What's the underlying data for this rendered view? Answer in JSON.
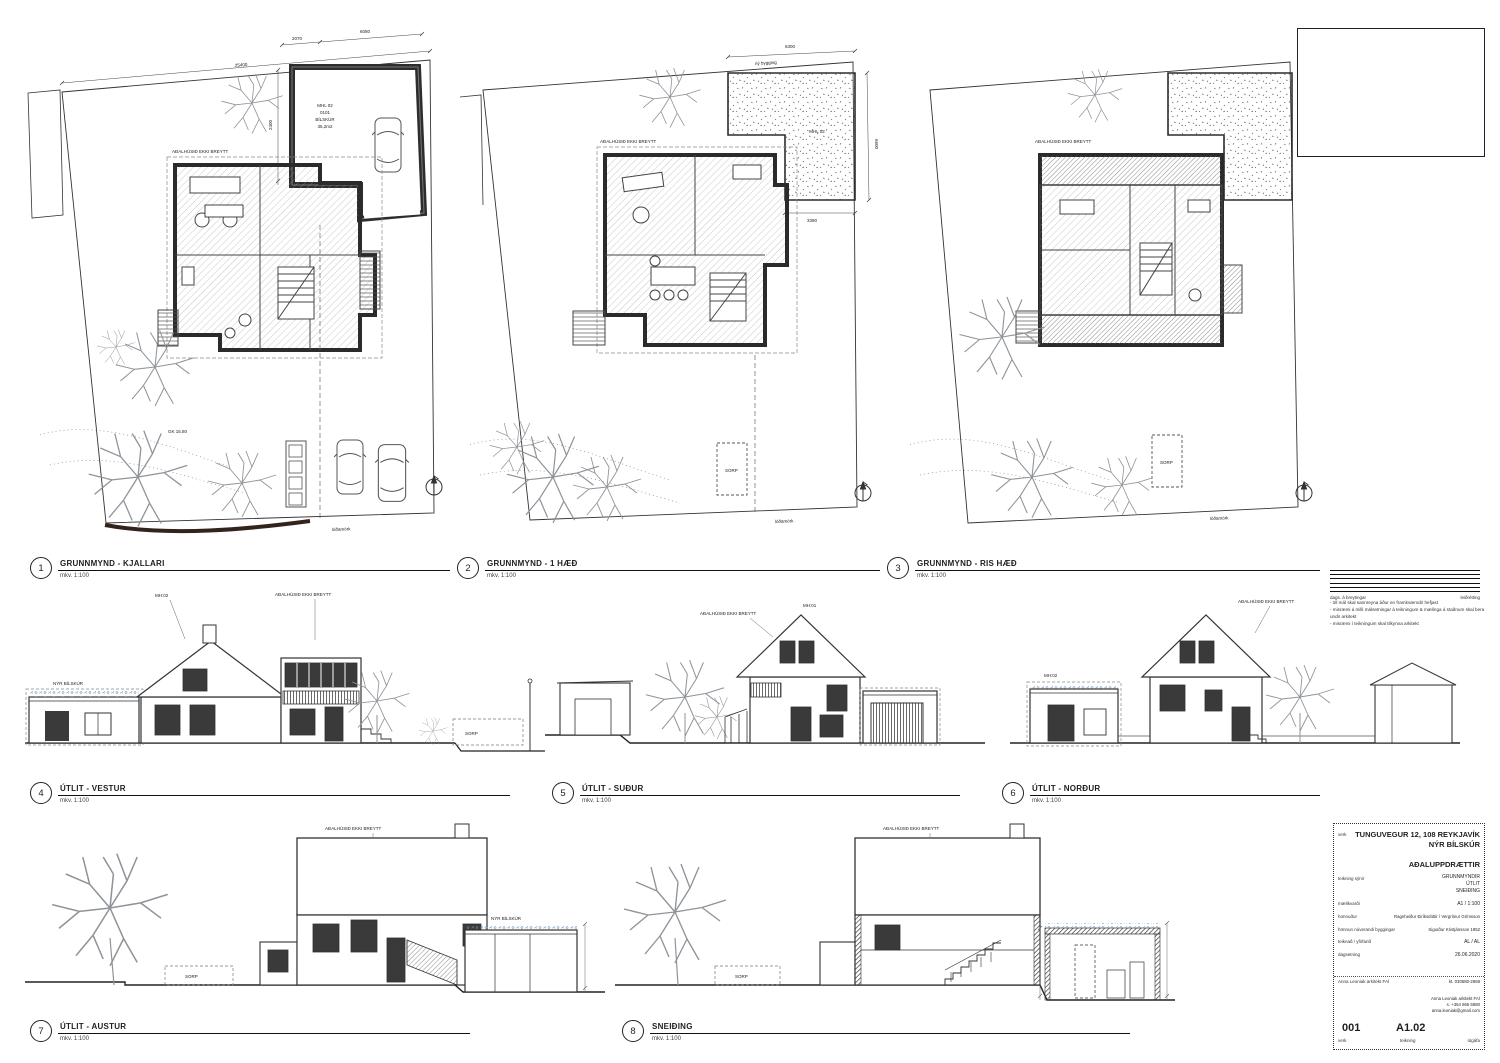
{
  "sheet": {
    "paper": "#ffffff",
    "ink": "#1f1f1f",
    "tree": "#8f949a",
    "sedum": "#6d8fae",
    "stipple": "#5a6b5a"
  },
  "plans": [
    {
      "num": "1",
      "title": "GRUNNMYND - KJALLARI",
      "scale": "mkv. 1:100",
      "house_note": "AÐALHÚSIÐ EKKI BREYTT",
      "lot_label": "lóðamörk",
      "gk": "GK 15.80",
      "garage": {
        "mhl": "MHL 02",
        "room_no": "0101",
        "name": "BÍLSKÚR",
        "area": "35,2m2"
      },
      "dims": {
        "site": "25400",
        "left": "2400",
        "top1": "2070",
        "top2": "6080"
      }
    },
    {
      "num": "2",
      "title": "GRUNNMYND - 1 HÆÐ",
      "scale": "mkv. 1:100",
      "house_note": "AÐALHÚSIÐ EKKI BREYTT",
      "lot_label": "lóðamörk",
      "sorp": "SORP",
      "roof": {
        "mhl": "MHL 02",
        "note": "ný bygging"
      },
      "dims": {
        "top": "6300",
        "right": "6600",
        "bottom": "3390"
      }
    },
    {
      "num": "3",
      "title": "GRUNNMYND - RIS HÆÐ",
      "scale": "mkv. 1:100",
      "house_note": "AÐALHÚSIÐ EKKI BREYTT",
      "lot_label": "lóðamörk",
      "sorp": "SORP"
    }
  ],
  "elevations": [
    {
      "num": "4",
      "title": "ÚTLIT - VESTUR",
      "scale": "mkv. 1:100",
      "house_note": "AÐALHÚSIÐ EKKI BREYTT",
      "mh": "MH:02",
      "bilskur": "NÝR BÍLSKÚR",
      "sorp": "SORP"
    },
    {
      "num": "5",
      "title": "ÚTLIT - SUÐUR",
      "scale": "mkv. 1:100",
      "house_note": "AÐALHÚSIÐ EKKI BREYTT",
      "mh": "MH:01"
    },
    {
      "num": "6",
      "title": "ÚTLIT - NORÐUR",
      "scale": "mkv. 1:100",
      "house_note": "AÐALHÚSIÐ EKKI BREYTT",
      "mh": "MH:02"
    },
    {
      "num": "7",
      "title": "ÚTLIT - AUSTUR",
      "scale": "mkv. 1:100",
      "house_note": "AÐALHÚSIÐ EKKI BREYTT",
      "bilskur": "NÝR BÍLSKÚR",
      "sorp": "SORP"
    },
    {
      "num": "8",
      "title": "SNEIÐING",
      "scale": "mkv. 1:100",
      "house_note": "AÐALHÚSIÐ EKKI BREYTT",
      "sorp": "SORP"
    }
  ],
  "revision": {
    "left_label": "dags. á breytingar",
    "right_label": "leiðrétting"
  },
  "notes": [
    "- öll mál skal sannreyna áður en framkvæmdir hefjast",
    "- misræmi á milli málsetningar á teikningum & mælinga á staðnum skal bera undir arkitekt",
    "- misræmi í teikningum skal tilkynna arkitekt"
  ],
  "titleblock": {
    "project_label": "verk",
    "project_line1": "TUNGUVEGUR 12, 108 REYKJAVÍK",
    "project_line2": "NÝR BÍLSKÚR",
    "doc_type": "AÐALUPPDRÆTTIR",
    "shows_label": "teikning sýnir",
    "shows1": "GRUNNMYNDIR",
    "shows2": "ÚTLIT",
    "shows3": "SNEIÐING",
    "scale_label": "mælikvarði",
    "scale_value": "A1 / 1:100",
    "designer_label": "hönnuður",
    "designer_value": "Ragnheiður Eiríksdóttir / Vergrímur Grímsson",
    "orig_label": "hönnun núverandi byggingar",
    "orig_value": "Sigurður Kristjánsson 1952",
    "drawn_label": "teiknað / yfirfarið",
    "drawn_value": "AL / AL",
    "date_label": "dagsetning",
    "date_value": "26.06.2020",
    "firm_name": "Anna Leoniak arkitekt FAÍ",
    "firm_id": "kt. 030580-2869",
    "contact1": "Anna Leoniak arkitekt FAÍ",
    "contact2": "s. +354 865 5880",
    "contact3": "anna.leoniak@gmail.com",
    "sheet_no": "001",
    "sheet_no_label": "verk",
    "drawing_no": "A1.02",
    "drawing_no_label": "teikning",
    "issue_label": "útgáfa"
  }
}
